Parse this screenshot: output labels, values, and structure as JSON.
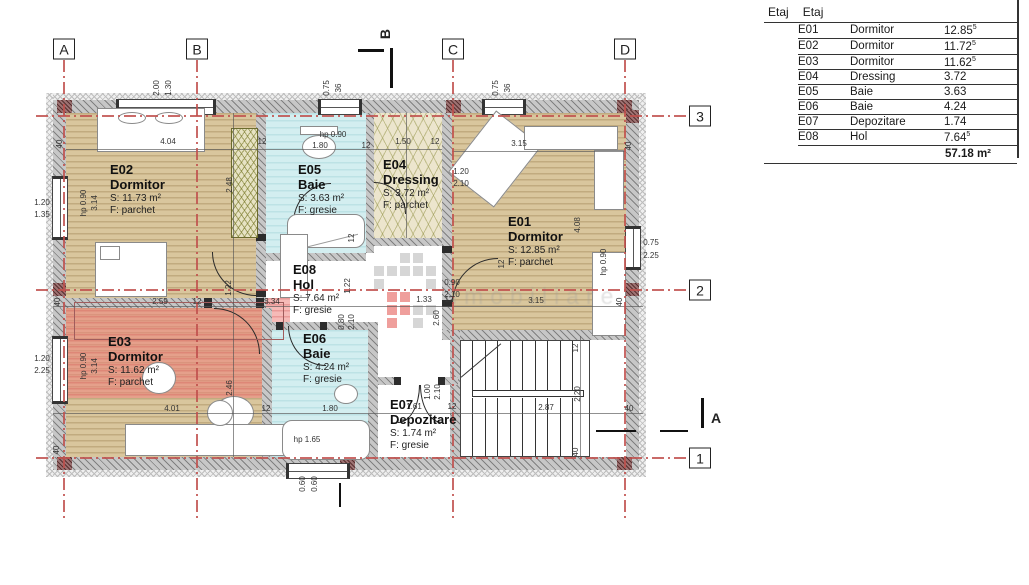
{
  "legend": {
    "header_col1": "Etaj",
    "header_col2": "Etaj",
    "rows": [
      {
        "code": "E01",
        "name": "Dormitor",
        "area": "12.85",
        "sup": "5"
      },
      {
        "code": "E02",
        "name": "Dormitor",
        "area": "11.72",
        "sup": "5"
      },
      {
        "code": "E03",
        "name": "Dormitor",
        "area": "11.62",
        "sup": "5"
      },
      {
        "code": "E04",
        "name": "Dressing",
        "area": "3.72",
        "sup": ""
      },
      {
        "code": "E05",
        "name": "Baie",
        "area": "3.63",
        "sup": ""
      },
      {
        "code": "E06",
        "name": "Baie",
        "area": "4.24",
        "sup": ""
      },
      {
        "code": "E07",
        "name": "Depozitare",
        "area": "1.74",
        "sup": ""
      },
      {
        "code": "E08",
        "name": "Hol",
        "area": "7.64",
        "sup": "5"
      }
    ],
    "total": "57.18 m²"
  },
  "rooms": {
    "e01": {
      "code": "E01",
      "name": "Dormitor",
      "area": "S: 12.85 m²",
      "floor": "F: parchet"
    },
    "e02": {
      "code": "E02",
      "name": "Dormitor",
      "area": "S: 11.73 m²",
      "floor": "F: parchet"
    },
    "e03": {
      "code": "E03",
      "name": "Dormitor",
      "area": "S: 11.62 m²",
      "floor": "F: parchet"
    },
    "e04": {
      "code": "E04",
      "name": "Dressing",
      "area": "S: 3.72 m²",
      "floor": "F: parchet"
    },
    "e05": {
      "code": "E05",
      "name": "Baie",
      "area": "S: 3.63 m²",
      "floor": "F: gresie"
    },
    "e06": {
      "code": "E06",
      "name": "Baie",
      "area": "S: 4.24 m²",
      "floor": "F: gresie"
    },
    "e07": {
      "code": "E07",
      "name": "Depozitare",
      "area": "S: 1.74 m²",
      "floor": "F: gresie"
    },
    "e08": {
      "code": "E08",
      "name": "Hol",
      "area": "S: 7.64 m²",
      "floor": "F: gresie"
    }
  },
  "grid": {
    "cols": [
      {
        "label": "A",
        "x": 64
      },
      {
        "label": "B",
        "x": 197
      },
      {
        "label": "C",
        "x": 453
      },
      {
        "label": "D",
        "x": 625
      }
    ],
    "rows": [
      {
        "label": "3",
        "y": 116
      },
      {
        "label": "2",
        "y": 290
      },
      {
        "label": "1",
        "y": 458
      }
    ],
    "section_top": "B",
    "section_right": "A"
  },
  "dims": [
    [
      "2.00",
      157,
      88,
      1
    ],
    [
      "1.30",
      169,
      88,
      1
    ],
    [
      "0.75",
      327,
      88,
      1
    ],
    [
      "36",
      339,
      88,
      1
    ],
    [
      "0.75",
      496,
      88,
      1
    ],
    [
      "36",
      508,
      88,
      1
    ],
    [
      "4.04",
      168,
      142,
      0
    ],
    [
      "12",
      262,
      142,
      0
    ],
    [
      "hp 0.90",
      333,
      135,
      0
    ],
    [
      "1.80",
      320,
      146,
      0
    ],
    [
      "12",
      366,
      146,
      0
    ],
    [
      "1.50",
      403,
      142,
      0
    ],
    [
      "12",
      435,
      142,
      0
    ],
    [
      "3.15",
      519,
      144,
      0
    ],
    [
      "40",
      629,
      146,
      1
    ],
    [
      "1.20",
      461,
      172,
      0
    ],
    [
      "2.10",
      461,
      184,
      0
    ],
    [
      "40",
      60,
      144,
      1
    ],
    [
      "hp 0.90",
      84,
      203,
      1
    ],
    [
      "3.14",
      95,
      203,
      1
    ],
    [
      "1.20",
      42,
      203,
      0
    ],
    [
      "1.35",
      42,
      215,
      0
    ],
    [
      "2.48",
      230,
      185,
      1
    ],
    [
      "12",
      352,
      238,
      1
    ],
    [
      "12",
      502,
      264,
      1
    ],
    [
      "4.08",
      578,
      225,
      1
    ],
    [
      "hp 0.90",
      604,
      262,
      1
    ],
    [
      "0.75",
      651,
      243,
      0
    ],
    [
      "2.25",
      651,
      256,
      0
    ],
    [
      "40",
      58,
      302,
      1
    ],
    [
      "2.59",
      160,
      302,
      0
    ],
    [
      "12",
      197,
      302,
      0
    ],
    [
      "3.34",
      272,
      302,
      0
    ],
    [
      "1.22",
      229,
      288,
      1
    ],
    [
      "1.22",
      348,
      286,
      1
    ],
    [
      "0.90",
      452,
      283,
      0
    ],
    [
      "2.10",
      452,
      295,
      0
    ],
    [
      "1.33",
      424,
      300,
      0
    ],
    [
      "12",
      449,
      300,
      0
    ],
    [
      "3.15",
      536,
      301,
      0
    ],
    [
      "40",
      620,
      302,
      1
    ],
    [
      "2.60",
      437,
      318,
      1
    ],
    [
      "hp 0.90",
      84,
      366,
      1
    ],
    [
      "3.14",
      95,
      366,
      1
    ],
    [
      "1.20",
      42,
      359,
      0
    ],
    [
      "2.25",
      42,
      371,
      0
    ],
    [
      "2.46",
      230,
      388,
      1
    ],
    [
      "0.80",
      342,
      322,
      1
    ],
    [
      "2.10",
      352,
      322,
      1
    ],
    [
      "12",
      576,
      348,
      1
    ],
    [
      "2.20",
      578,
      394,
      1
    ],
    [
      "1.00",
      428,
      392,
      1
    ],
    [
      "2.10",
      438,
      392,
      1
    ],
    [
      "4.01",
      172,
      409,
      0
    ],
    [
      "12",
      266,
      409,
      0
    ],
    [
      "1.80",
      330,
      409,
      0
    ],
    [
      "1.61",
      414,
      407,
      0
    ],
    [
      "12",
      452,
      407,
      0
    ],
    [
      "2.87",
      546,
      408,
      0
    ],
    [
      "40",
      629,
      409,
      0
    ],
    [
      "hp 1.65",
      307,
      440,
      0
    ],
    [
      "40",
      57,
      450,
      1
    ],
    [
      "40",
      576,
      452,
      1
    ],
    [
      "0.60",
      303,
      484,
      1
    ],
    [
      "0.60",
      315,
      484,
      1
    ]
  ],
  "watermark": {
    "text": "imobiliare",
    "gray": "#b5b5b5",
    "red": "#e2514a",
    "squares": [
      {
        "x": 400,
        "y": 253,
        "c": "g"
      },
      {
        "x": 413,
        "y": 253,
        "c": "g"
      },
      {
        "x": 374,
        "y": 266,
        "c": "g"
      },
      {
        "x": 387,
        "y": 266,
        "c": "g"
      },
      {
        "x": 400,
        "y": 266,
        "c": "g"
      },
      {
        "x": 413,
        "y": 266,
        "c": "g"
      },
      {
        "x": 426,
        "y": 266,
        "c": "g"
      },
      {
        "x": 374,
        "y": 279,
        "c": "g"
      },
      {
        "x": 426,
        "y": 279,
        "c": "g"
      },
      {
        "x": 387,
        "y": 292,
        "c": "r"
      },
      {
        "x": 400,
        "y": 292,
        "c": "r"
      },
      {
        "x": 387,
        "y": 305,
        "c": "r"
      },
      {
        "x": 400,
        "y": 305,
        "c": "r"
      },
      {
        "x": 413,
        "y": 305,
        "c": "g"
      },
      {
        "x": 426,
        "y": 305,
        "c": "g"
      },
      {
        "x": 387,
        "y": 318,
        "c": "r"
      },
      {
        "x": 413,
        "y": 318,
        "c": "g"
      }
    ]
  }
}
